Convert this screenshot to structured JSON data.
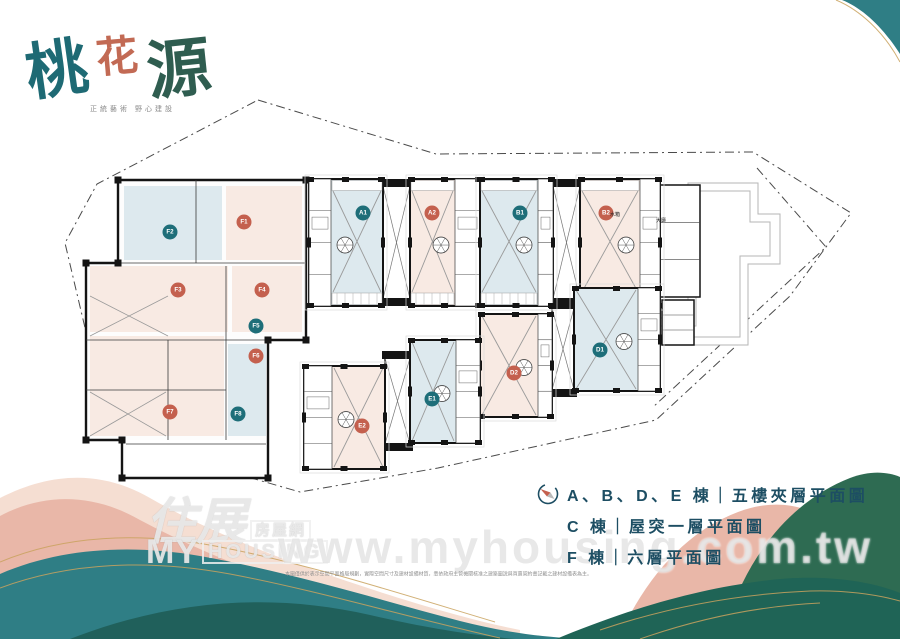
{
  "logo": {
    "chars": [
      {
        "t": "桃"
      },
      {
        "t": "花"
      },
      {
        "t": "源"
      }
    ],
    "tagline": "正統藝術 野心建設"
  },
  "legend": {
    "rows": [
      "A、B、D、E 棟｜五樓夾層平面圖",
      "C 棟｜屋突一層平面圖",
      "F 棟｜六層平面圖"
    ]
  },
  "watermark": {
    "site_zh": "住展",
    "site_zh_suffix": "房屋網",
    "site_en_1": "MY",
    "site_en_2": "HOUSING",
    "url": "www.myhousing.com.tw"
  },
  "disclaimer": "本圖僅供於表示空間平面格局規劃，實際空間尺寸及建材設備材質，悉依政府主管機關核准之建築圖說與買賣契約書記載之建材設備表為主。",
  "colors": {
    "wall": "#141414",
    "boundary": "#4a4a4a",
    "c_outline": "#b5b5b5",
    "room_blue": "#dde9ee",
    "room_pink": "#f8eae3",
    "teal_unit": "#1e6e79",
    "salmon_unit": "#c4604e",
    "legend_text": "#1d4e63",
    "logo_1": "#1e6a74",
    "logo_2": "#c26a54",
    "logo_3": "#2f5d50",
    "wave_teal": "#2f7e85",
    "wave_deep": "#20605b",
    "wave_green": "#2e6b52",
    "wave_green_deep": "#1f6456",
    "wave_pink": "#e9b7a8",
    "wave_pink_light": "#f5ded2",
    "gold": "#c9a25e"
  },
  "floor_plan": {
    "boundary": {
      "outer": [
        [
          258,
          100
        ],
        [
          436,
          154
        ],
        [
          753,
          152
        ],
        [
          851,
          213
        ],
        [
          790,
          296
        ],
        [
          656,
          420
        ],
        [
          438,
          468
        ],
        [
          300,
          492
        ],
        [
          112,
          438
        ],
        [
          86,
          332
        ],
        [
          65,
          243
        ],
        [
          97,
          184
        ]
      ],
      "inner": [
        [
          757,
          168
        ],
        [
          826,
          247
        ],
        [
          652,
          408
        ]
      ]
    },
    "c_building": {
      "outlines": [
        [
          [
            688,
            183
          ],
          [
            758,
            183
          ],
          [
            758,
            214
          ],
          [
            780,
            214
          ],
          [
            780,
            264
          ],
          [
            748,
            264
          ],
          [
            748,
            345
          ],
          [
            652,
            345
          ],
          [
            652,
            318
          ],
          [
            688,
            318
          ]
        ],
        [
          [
            696,
            191
          ],
          [
            750,
            191
          ],
          [
            750,
            222
          ],
          [
            770,
            222
          ],
          [
            770,
            256
          ],
          [
            740,
            256
          ],
          [
            740,
            337
          ],
          [
            660,
            337
          ],
          [
            660,
            326
          ],
          [
            696,
            326
          ]
        ]
      ]
    },
    "f_wing": {
      "outline": [
        [
          118,
          180
        ],
        [
          306,
          180
        ],
        [
          306,
          340
        ],
        [
          268,
          340
        ],
        [
          268,
          478
        ],
        [
          122,
          478
        ],
        [
          122,
          440
        ],
        [
          86,
          440
        ],
        [
          86,
          263
        ],
        [
          118,
          263
        ]
      ],
      "tints": [
        {
          "x": 124,
          "y": 186,
          "w": 98,
          "h": 74,
          "tint": "blue"
        },
        {
          "x": 226,
          "y": 186,
          "w": 76,
          "h": 74,
          "tint": "pink"
        },
        {
          "x": 90,
          "y": 266,
          "w": 138,
          "h": 66,
          "tint": "pink"
        },
        {
          "x": 232,
          "y": 266,
          "w": 70,
          "h": 66,
          "tint": "pink"
        },
        {
          "x": 90,
          "y": 336,
          "w": 134,
          "h": 100,
          "tint": "pink"
        },
        {
          "x": 228,
          "y": 344,
          "w": 38,
          "h": 92,
          "tint": "blue"
        },
        {
          "x": 126,
          "y": 440,
          "w": 140,
          "h": 34,
          "tint": "white"
        }
      ],
      "segments": [
        [
          118,
          263,
          306,
          263
        ],
        [
          86,
          340,
          268,
          340
        ],
        [
          196,
          180,
          196,
          263
        ],
        [
          226,
          266,
          226,
          340
        ],
        [
          168,
          340,
          168,
          440
        ],
        [
          226,
          340,
          226,
          440
        ],
        [
          126,
          444,
          266,
          444
        ],
        [
          86,
          390,
          226,
          390
        ]
      ],
      "crosses": [
        {
          "x": 90,
          "y": 296,
          "w": 78,
          "h": 40
        },
        {
          "x": 90,
          "y": 392,
          "w": 76,
          "h": 44
        }
      ],
      "circles": [
        {
          "cx": 170,
          "cy": 232,
          "color": "teal",
          "label": "F2"
        },
        {
          "cx": 244,
          "cy": 222,
          "color": "salmon",
          "label": "F1"
        },
        {
          "cx": 178,
          "cy": 290,
          "color": "salmon",
          "label": "F3"
        },
        {
          "cx": 262,
          "cy": 290,
          "color": "salmon",
          "label": "F4"
        },
        {
          "cx": 256,
          "cy": 326,
          "color": "teal",
          "label": "F5"
        },
        {
          "cx": 256,
          "cy": 356,
          "color": "salmon",
          "label": "F6"
        },
        {
          "cx": 170,
          "cy": 412,
          "color": "salmon",
          "label": "F7"
        },
        {
          "cx": 238,
          "cy": 414,
          "color": "teal",
          "label": "F8"
        }
      ]
    },
    "cores": [
      {
        "x": 383,
        "y": 186,
        "w": 27,
        "h": 113
      },
      {
        "x": 553,
        "y": 186,
        "w": 27,
        "h": 113
      },
      {
        "x": 385,
        "y": 358,
        "w": 25,
        "h": 86
      },
      {
        "x": 552,
        "y": 308,
        "w": 22,
        "h": 82
      }
    ],
    "annex": [
      {
        "x": 660,
        "y": 185,
        "w": 40,
        "h": 112
      },
      {
        "x": 662,
        "y": 300,
        "w": 32,
        "h": 45
      }
    ],
    "units": [
      {
        "id": "A1",
        "x": 309,
        "y": 179,
        "w": 74,
        "h": 127,
        "tint": "blue",
        "rooms": "left",
        "rw": 22,
        "balcony": true,
        "circle": {
          "cx": 363,
          "cy": 213,
          "color": "teal",
          "label": "A1"
        }
      },
      {
        "id": "A2",
        "x": 410,
        "y": 179,
        "w": 70,
        "h": 127,
        "tint": "pink",
        "rooms": "right",
        "rw": 25,
        "balcony": true,
        "circle": {
          "cx": 432,
          "cy": 213,
          "color": "salmon",
          "label": "A2"
        }
      },
      {
        "id": "B1",
        "x": 480,
        "y": 179,
        "w": 73,
        "h": 127,
        "tint": "blue",
        "rooms": "right",
        "rw": 15,
        "balcony": true,
        "circle": {
          "cx": 520,
          "cy": 213,
          "color": "teal",
          "label": "B1"
        }
      },
      {
        "id": "B2",
        "x": 580,
        "y": 179,
        "w": 80,
        "h": 127,
        "tint": "pink",
        "rooms": "right",
        "rw": 20,
        "balcony": true,
        "circle": {
          "cx": 606,
          "cy": 213,
          "color": "salmon",
          "label": "B2"
        }
      },
      {
        "id": "D1",
        "x": 574,
        "y": 288,
        "w": 86,
        "h": 103,
        "tint": "blue",
        "rooms": "right",
        "rw": 22,
        "balcony": false,
        "circle": {
          "cx": 600,
          "cy": 350,
          "color": "teal",
          "label": "D1"
        }
      },
      {
        "id": "D2",
        "x": 480,
        "y": 314,
        "w": 72,
        "h": 103,
        "tint": "pink",
        "rooms": "right",
        "rw": 14,
        "balcony": false,
        "circle": {
          "cx": 514,
          "cy": 373,
          "color": "salmon",
          "label": "D2"
        }
      },
      {
        "id": "E1",
        "x": 410,
        "y": 340,
        "w": 70,
        "h": 103,
        "tint": "blue",
        "rooms": "right",
        "rw": 24,
        "balcony": false,
        "circle": {
          "cx": 432,
          "cy": 399,
          "color": "teal",
          "label": "E1"
        }
      },
      {
        "id": "E2",
        "x": 304,
        "y": 366,
        "w": 81,
        "h": 103,
        "tint": "pink",
        "rooms": "left",
        "rw": 28,
        "balcony": false,
        "circle": {
          "cx": 362,
          "cy": 426,
          "color": "salmon",
          "label": "E2"
        }
      }
    ],
    "texts": [
      {
        "t": "水箱",
        "x": 610,
        "y": 216
      },
      {
        "t": "大廳",
        "x": 656,
        "y": 222
      }
    ]
  }
}
